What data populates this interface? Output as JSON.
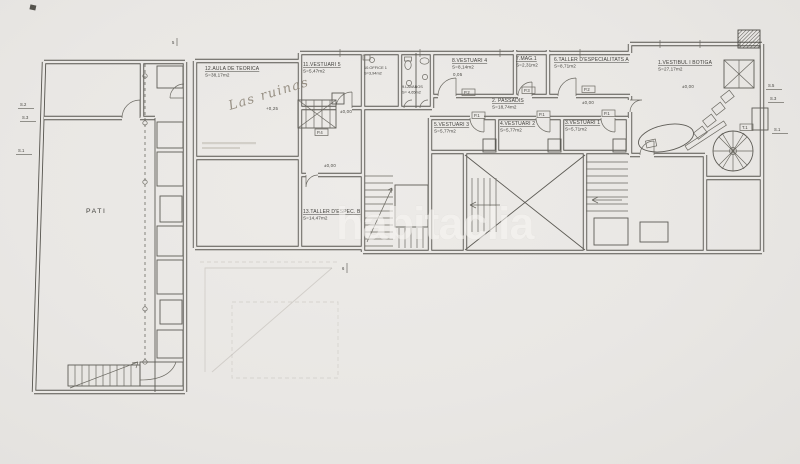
{
  "palette": {
    "paper": "#e9e7e4",
    "line": "#56544e",
    "watermark": "#f7f5f2",
    "pencil": "#837a6c"
  },
  "watermark": {
    "text": "habitaclia"
  },
  "handwriting": {
    "text": "Las ruinas"
  },
  "rooms": {
    "vestibul": {
      "name": "1.VESTIBUL I BOTIGA",
      "area": "S=27,17m2"
    },
    "passadis": {
      "name": "2. PASSADIS",
      "area": "S=18,74m2"
    },
    "vestuari1": {
      "name": "3.VESTUARI 1",
      "area": "S=5,71m2"
    },
    "vestuari2": {
      "name": "4.VESTUARI 2",
      "area": "S=5,77m2"
    },
    "vestuari3": {
      "name": "5.VESTUARI 3",
      "area": "S=5,77m2"
    },
    "taller_a": {
      "name": "6.TALLER D'ESPECIALITATS A",
      "area": "S=8,71m2"
    },
    "mag1": {
      "name": "7.MAG.1",
      "area": "S=2,31m2"
    },
    "vestuari4": {
      "name": "8.VESTUARI 4",
      "area": "S=8,14m2"
    },
    "lavabos": {
      "name": "9.LAVABOS",
      "area": "S= 4,65m2"
    },
    "office": {
      "name": "10.OFFICE 1",
      "area": "S=3,94m2"
    },
    "vestuari5": {
      "name": "11.VESTUARI 5",
      "area": "S=5,47m2"
    },
    "aula": {
      "name": "12.AULA DE TEORICA",
      "area": "S=38,17m2"
    },
    "taller_b": {
      "name": "13.TALLER D'ESPEC. B",
      "area": "S=14,47m2"
    },
    "pati": {
      "name": "PATI"
    }
  },
  "levels": {
    "zero": "±0,00",
    "plus25": "+0,25",
    "plus05": "0,05"
  },
  "section_tags": {
    "left": [
      "S.2",
      "S.3",
      "S.1"
    ],
    "right": [
      "S.5",
      "S.3",
      "S.1"
    ],
    "top": "5",
    "bottom": "6"
  },
  "door_tags": {
    "p1": "P.1",
    "p2": "P.2",
    "p3": "P.3",
    "p4": "P.4",
    "t1": "T.1"
  }
}
